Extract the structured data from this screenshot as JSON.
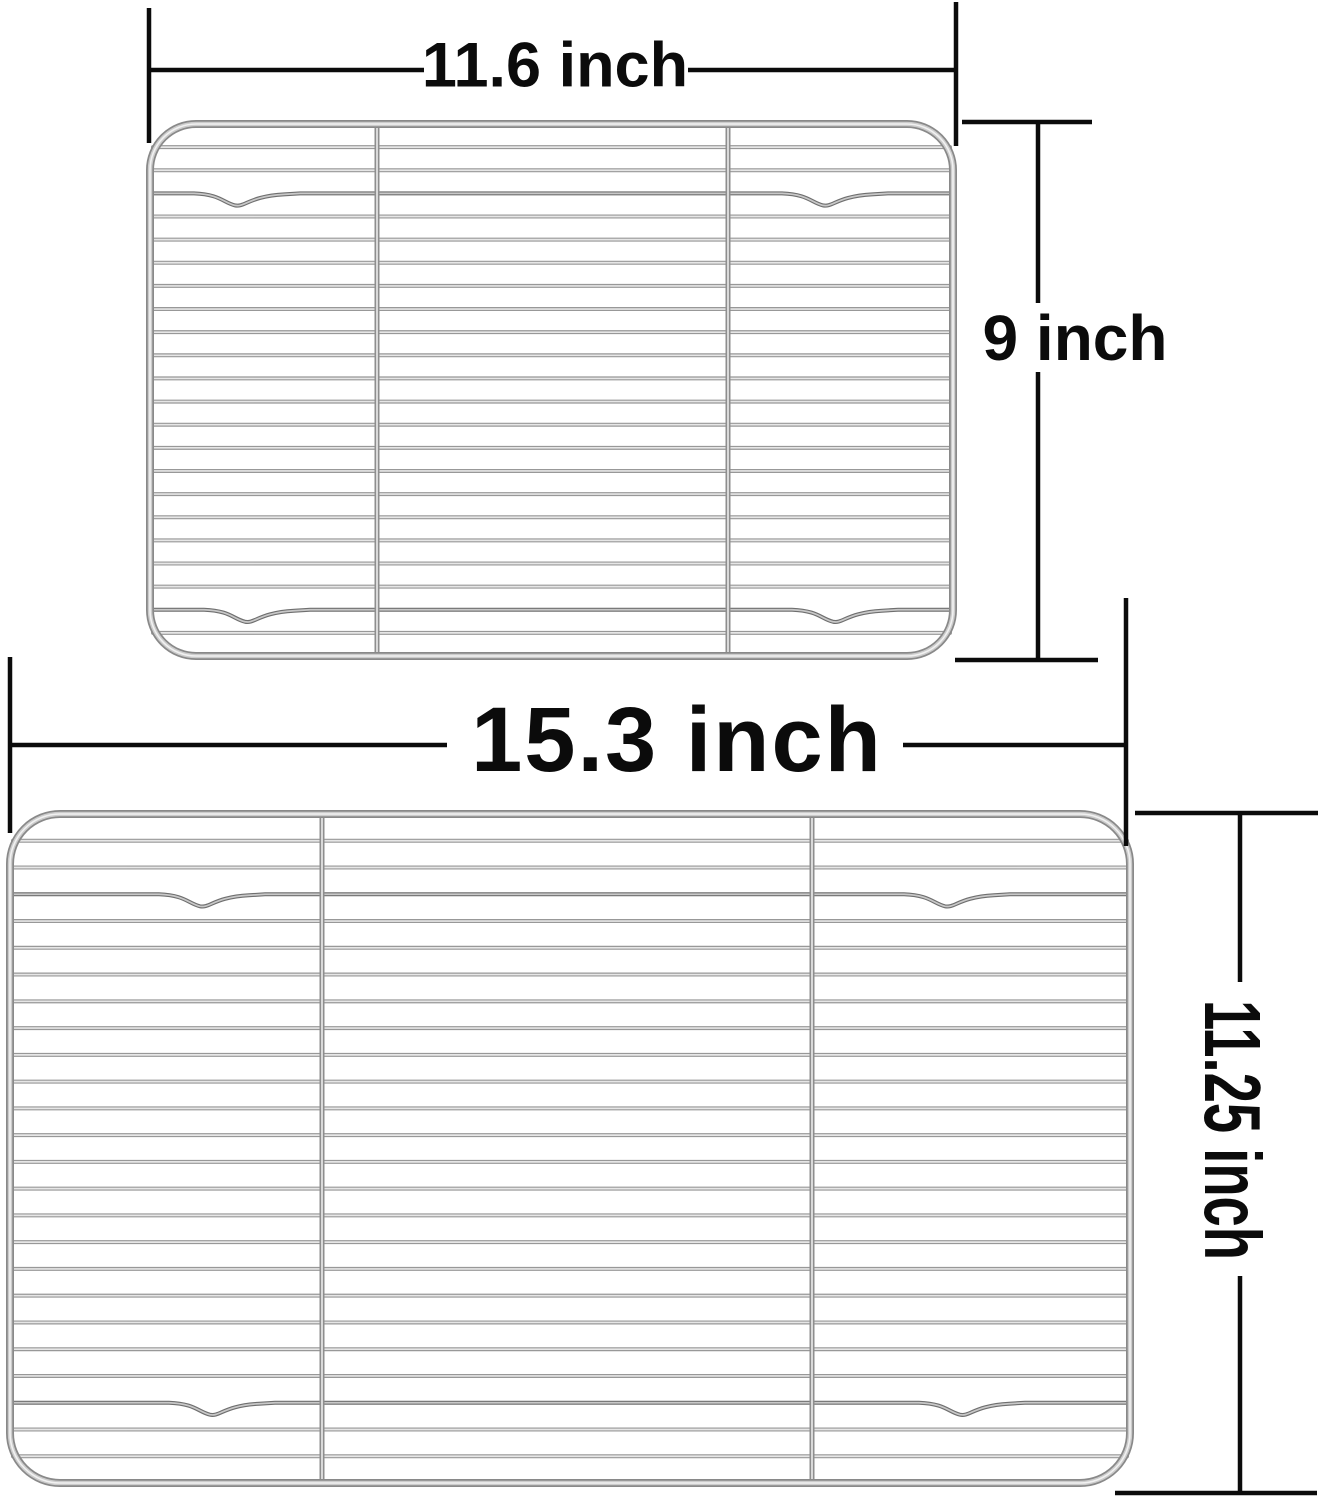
{
  "figure": {
    "type": "product-dimension-diagram",
    "racks": [
      {
        "name": "small-rack",
        "width_label": "11.6 inch",
        "height_label": "9 inch",
        "frame": {
          "x": 150,
          "y": 124,
          "w": 803,
          "h": 532,
          "r": 46
        },
        "bars": [
          377,
          728
        ],
        "wires": 22,
        "notches": [
          {
            "wire": 3,
            "xs": [
              240,
              828
            ]
          },
          {
            "wire": 21,
            "xs": [
              250,
              838
            ]
          }
        ]
      },
      {
        "name": "large-rack",
        "width_label": "15.3 inch",
        "height_label": "11.25 inch",
        "frame": {
          "x": 10,
          "y": 814,
          "w": 1120,
          "h": 669,
          "r": 50
        },
        "bars": [
          322,
          812
        ],
        "wires": 24,
        "notches": [
          {
            "wire": 3,
            "xs": [
              205,
              950
            ]
          },
          {
            "wire": 22,
            "xs": [
              215,
              965
            ]
          }
        ]
      }
    ],
    "annotation_lines": {
      "small_width": [
        [
          149,
          8,
          149,
          143
        ],
        [
          956,
          2,
          956,
          146
        ],
        [
          150,
          70,
          424,
          70
        ],
        [
          688,
          70,
          956,
          70
        ]
      ],
      "small_height": [
        [
          962,
          122,
          1092,
          122
        ],
        [
          955,
          660,
          1098,
          660
        ],
        [
          1038,
          122,
          1038,
          303
        ],
        [
          1038,
          372,
          1038,
          660
        ]
      ],
      "large_width": [
        [
          10,
          657,
          10,
          833
        ],
        [
          1126,
          598,
          1126,
          846
        ],
        [
          10,
          745,
          447,
          745
        ],
        [
          903,
          745,
          1126,
          745
        ]
      ],
      "large_height": [
        [
          1135,
          813,
          1318,
          813
        ],
        [
          1115,
          1493,
          1317,
          1493
        ],
        [
          1240,
          813,
          1240,
          982
        ],
        [
          1240,
          1276,
          1240,
          1493
        ]
      ]
    },
    "colors": {
      "line": "#0b0b0b",
      "wire_dark": "#989898",
      "wire_light": "#e6e6e6",
      "notch_dark": "#6f6f6f",
      "notch_light": "#c8c8c8",
      "bar_dark": "#8e8e8e",
      "bar_light": "#d9d9d9",
      "frame_dark": "#898989",
      "frame_mid": "#cccccc",
      "frame_light": "#f1f1f1",
      "background": "#ffffff"
    }
  }
}
